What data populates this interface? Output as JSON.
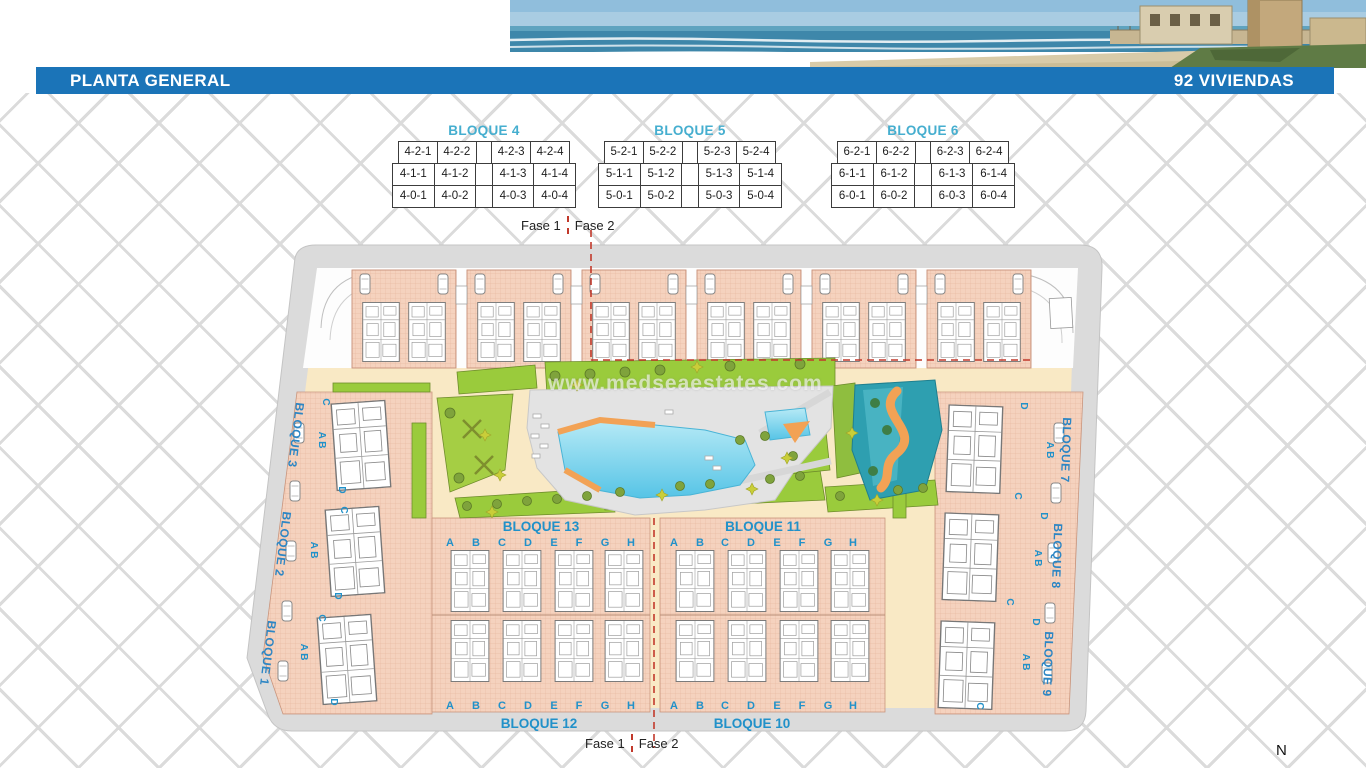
{
  "header": {
    "title": "PLANTA GENERAL",
    "units_label": "92 VIVIENDAS"
  },
  "bloque_tables": [
    {
      "title": "BLOQUE 4",
      "rows": [
        [
          "4-2-1",
          "4-2-2",
          "4-2-3",
          "4-2-4"
        ],
        [
          "4-1-1",
          "4-1-2",
          "4-1-3",
          "4-1-4"
        ],
        [
          "4-0-1",
          "4-0-2",
          "4-0-3",
          "4-0-4"
        ]
      ]
    },
    {
      "title": "BLOQUE 5",
      "rows": [
        [
          "5-2-1",
          "5-2-2",
          "5-2-3",
          "5-2-4"
        ],
        [
          "5-1-1",
          "5-1-2",
          "5-1-3",
          "5-1-4"
        ],
        [
          "5-0-1",
          "5-0-2",
          "5-0-3",
          "5-0-4"
        ]
      ]
    },
    {
      "title": "BLOQUE 6",
      "rows": [
        [
          "6-2-1",
          "6-2-2",
          "6-2-3",
          "6-2-4"
        ],
        [
          "6-1-1",
          "6-1-2",
          "6-1-3",
          "6-1-4"
        ],
        [
          "6-0-1",
          "6-0-2",
          "6-0-3",
          "6-0-4"
        ]
      ]
    }
  ],
  "plan": {
    "fase1": "Fase 1",
    "fase2": "Fase 2",
    "mid_blocks": {
      "top_left": "BLOQUE 13",
      "top_right": "BLOQUE 11",
      "bottom_left": "BLOQUE 12",
      "bottom_right": "BLOQUE 10"
    },
    "side_blocks": {
      "left": [
        "BLOQUE 3",
        "BLOQUE 2",
        "BLOQUE 1"
      ],
      "right": [
        "BLOQUE 7",
        "BLOQUE 8",
        "BLOQUE 9"
      ]
    },
    "unit_letters": [
      "A",
      "B",
      "C",
      "D",
      "E",
      "F",
      "G",
      "H"
    ],
    "side_letters": {
      "c": "C",
      "ab": "A B",
      "d": "D"
    },
    "watermark": "www.medseaestates.com",
    "north": "N"
  },
  "colors": {
    "bar_blue": "#1B74B8",
    "table_title_blue": "#45AECF",
    "plan_label_blue": "#2191C9",
    "salmon": "#F5D2BE",
    "pool_blue": "#7ED3EC",
    "phase_red": "#C2392B"
  }
}
